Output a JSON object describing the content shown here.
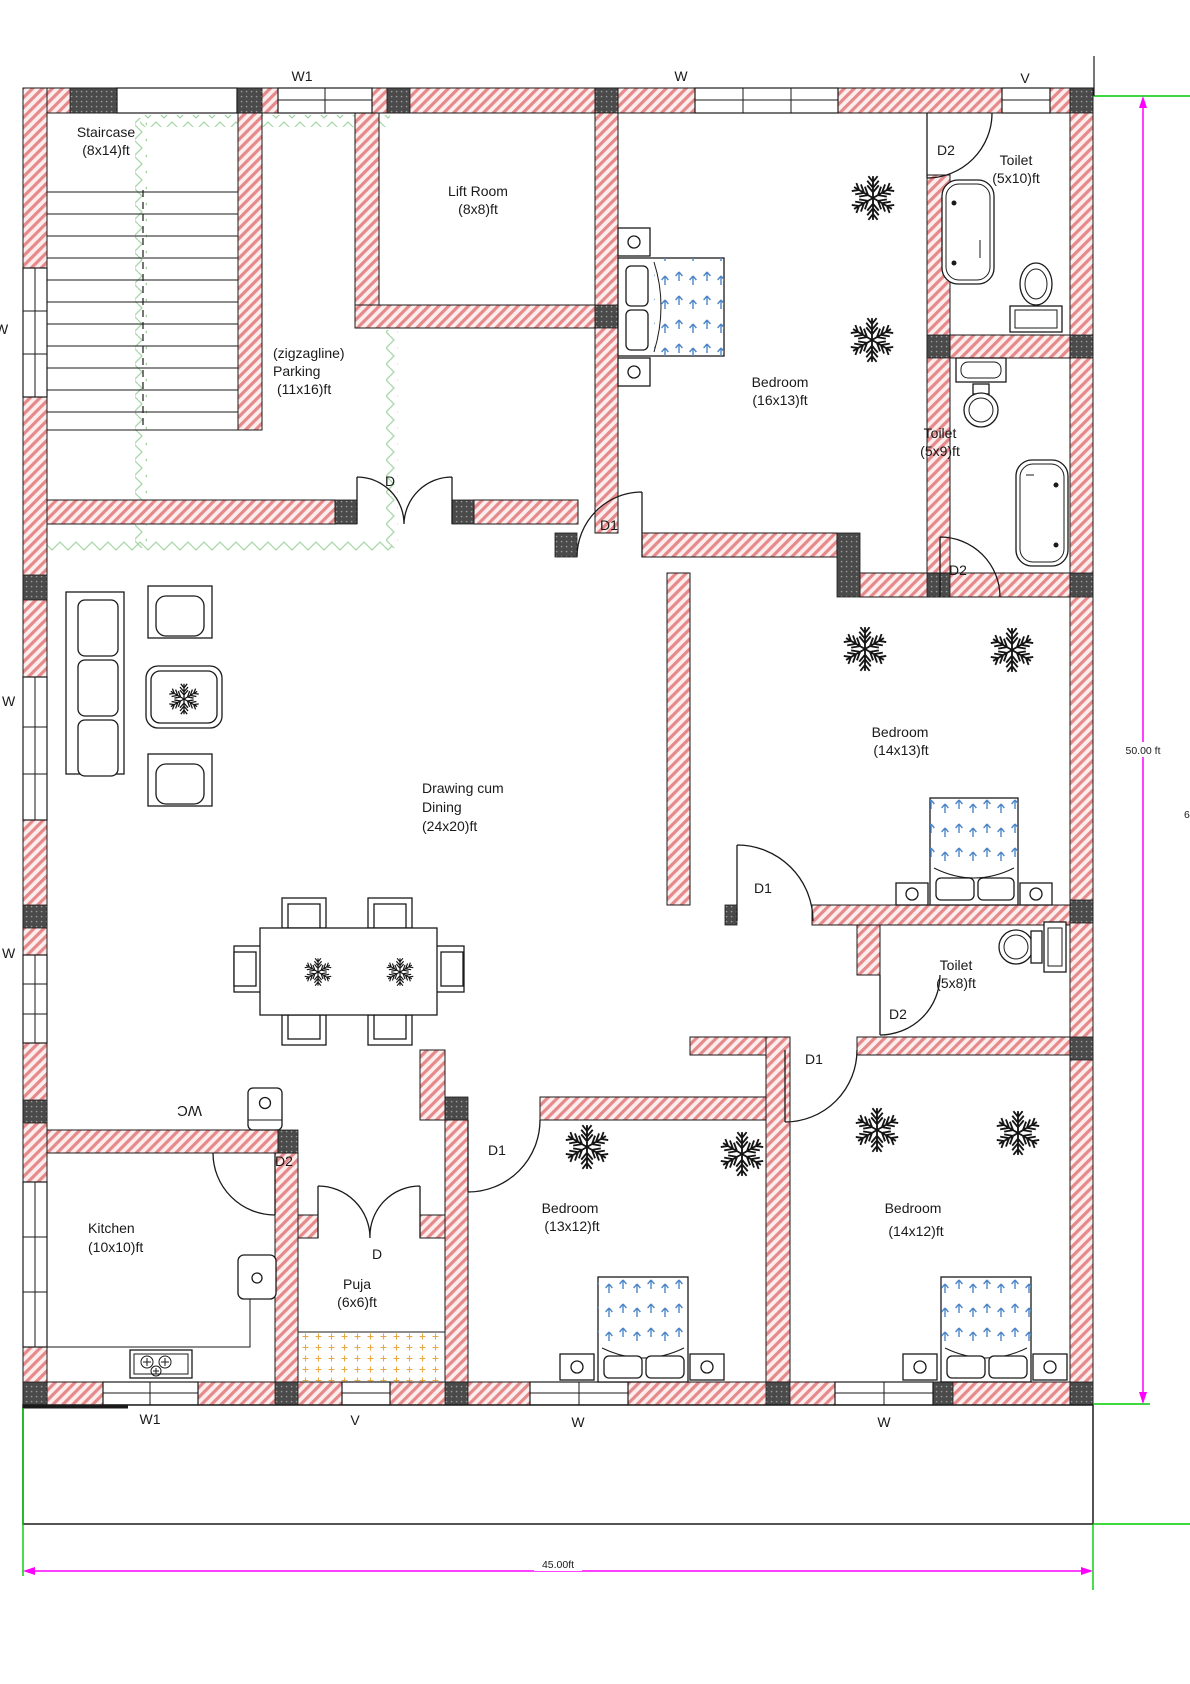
{
  "rooms": {
    "staircase": {
      "label": "Staircase",
      "size": "(8x14)ft"
    },
    "parking": {
      "note": "(zigzagline)",
      "label": "Parking",
      "size": "(11x16)ft"
    },
    "lift": {
      "label": "Lift Room",
      "size": "(8x8)ft"
    },
    "bedroom1": {
      "label": "Bedroom",
      "size": "(16x13)ft"
    },
    "toilet1": {
      "label": "Toilet",
      "size": "(5x10)ft"
    },
    "toilet2": {
      "label": "Toilet",
      "size": "(5x9)ft"
    },
    "bedroom2": {
      "label": "Bedroom",
      "size": "(14x13)ft"
    },
    "toilet3": {
      "label": "Toilet",
      "size": "(5x8)ft"
    },
    "drawing": {
      "line1": "Drawing cum",
      "line2": "Dining",
      "size": "(24x20)ft"
    },
    "kitchen": {
      "label": "Kitchen",
      "size": "(10x10)ft"
    },
    "puja": {
      "label": "Puja",
      "size": "(6x6)ft"
    },
    "bedroom3": {
      "label": "Bedroom",
      "size": "(13x12)ft"
    },
    "bedroom4": {
      "label": "Bedroom",
      "size": "(14x12)ft"
    }
  },
  "doors": {
    "d": "D",
    "d1": "D1",
    "d2": "D2"
  },
  "windows": {
    "w": "W",
    "w1": "W1",
    "v": "V"
  },
  "labels": {
    "wc": "WC"
  },
  "dimensions": {
    "height": "50.00 ft",
    "width": "45.00ft",
    "right_edge_partial": "6"
  },
  "colors": {
    "wall_stripe": "#e5898b",
    "wall_bg": "#fdeeee",
    "column_block": "#4a4a4a",
    "zigzag_green": "#a8d8a8",
    "dimension_magenta": "#ff00ff",
    "dimension_green": "#00cc00",
    "bed_arrow_blue": "#4d86c8",
    "puja_dot_orange": "#e8a843"
  }
}
